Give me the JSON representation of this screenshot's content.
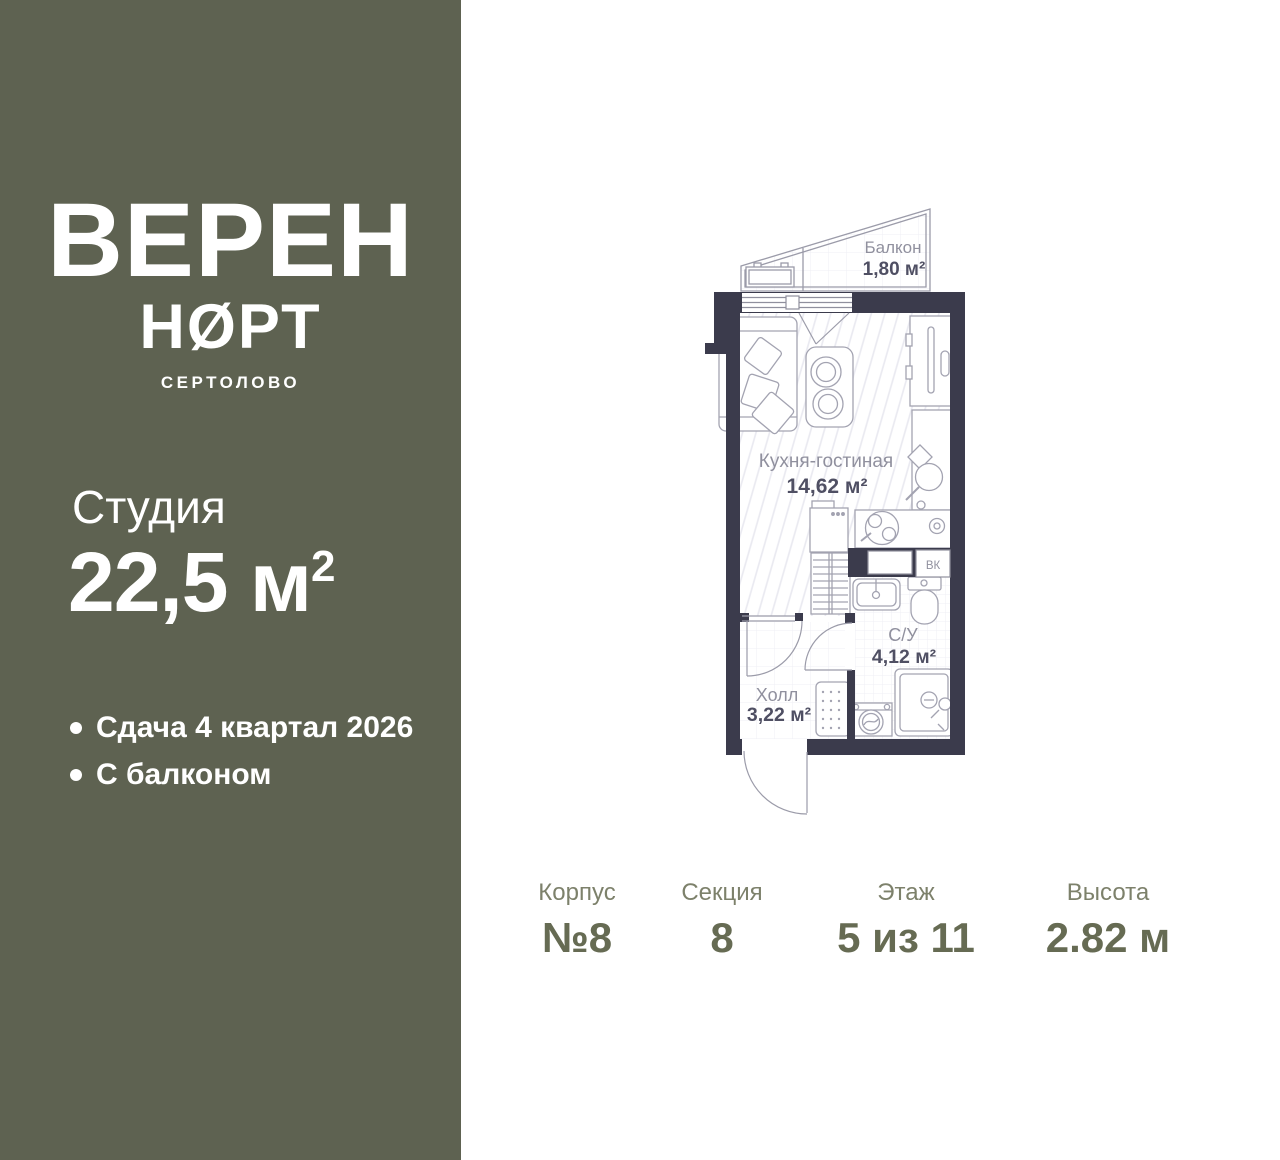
{
  "sidebar": {
    "logo_line1": "ВЕРЕН",
    "logo_line2": "НØРТ",
    "logo_subtitle": "СЕРТОЛОВО",
    "unit_type": "Студия",
    "area_main": "22,5 м",
    "area_sup": "2",
    "features": [
      {
        "text": "Сдача 4 квартал 2026"
      },
      {
        "text": "С балконом"
      }
    ]
  },
  "plan": {
    "rooms": [
      {
        "name": "Балкон",
        "area": "1,80 м²"
      },
      {
        "name": "Кухня-гостиная",
        "area": "14,62 м²"
      },
      {
        "name": "С/У",
        "area": "4,12 м²"
      },
      {
        "name": "Холл",
        "area": "3,22 м²"
      }
    ],
    "vk_label": "ВК"
  },
  "details": [
    {
      "label": "Корпус",
      "value": "№8"
    },
    {
      "label": "Секция",
      "value": "8"
    },
    {
      "label": "Этаж",
      "value": "5 из 11"
    },
    {
      "label": "Высота",
      "value": "2.82 м"
    }
  ],
  "colors": {
    "sidebar_bg": "#5e6251",
    "wall": "#3b3b4c",
    "plan_outline": "#9b9ba9",
    "plan_label": "#90909e",
    "plan_value": "#4f4f63",
    "details_label": "#7d816b",
    "details_value": "#666b53"
  }
}
